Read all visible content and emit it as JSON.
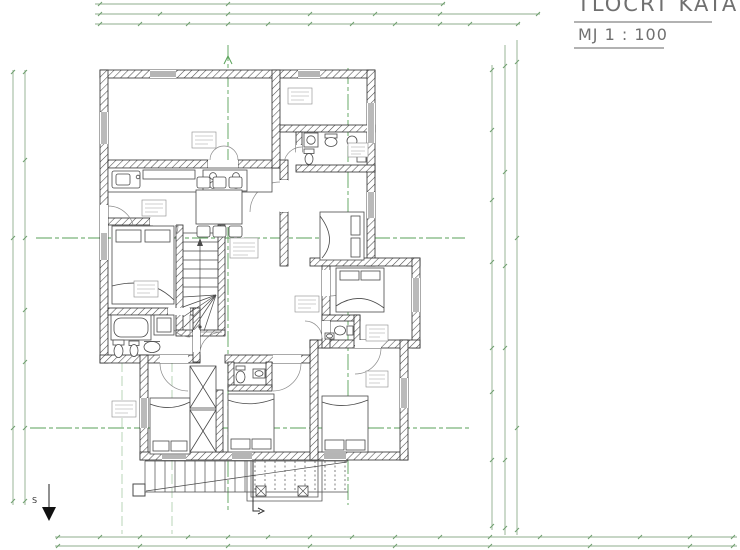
{
  "title_block": {
    "title": "TLOCRT KATA",
    "scale": "MJ 1 : 100"
  },
  "north_indicator": {
    "label": "S"
  },
  "colors": {
    "dimension_line_green": "#8fae8c",
    "section_line_green": "#58a258",
    "wall_black": "#2a2a2a",
    "furniture_gray": "#4a4a4a",
    "title_text_gray": "#707070",
    "background": "#ffffff"
  }
}
